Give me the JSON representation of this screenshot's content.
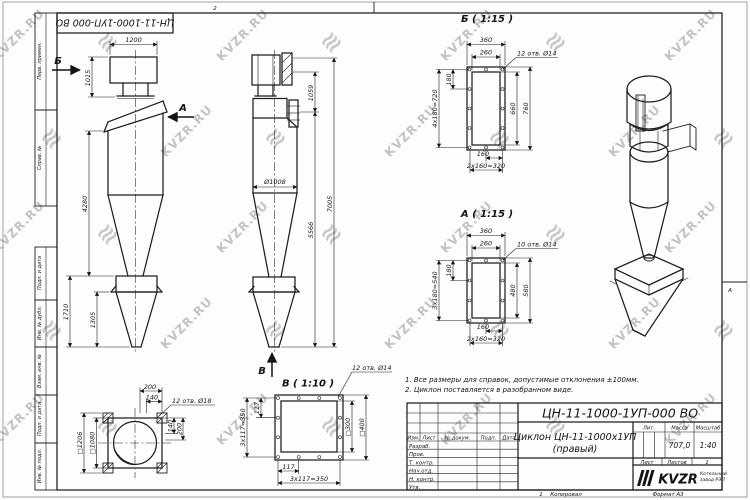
{
  "watermark": {
    "text": "KVZR.RU",
    "logo_glyph": "≋"
  },
  "frame": {
    "top_stamp": "ЦН-11-1000-1УП-000 ВО",
    "zone_top": "2",
    "zone_right": "А",
    "side_labels": [
      "Перв. примен.",
      "Справ. №",
      "Подп. и дата",
      "Инв. № дубл.",
      "Взам. инв. №",
      "Подп. и дата",
      "Инв. № подл."
    ],
    "footer": {
      "num": "1",
      "copy": "Копировал",
      "format": "Формат А3"
    }
  },
  "views": {
    "front": {
      "label_b": "Б",
      "label_a": "А",
      "dims": [
        "1200",
        "1015",
        "4280",
        "1710",
        "1305"
      ]
    },
    "side": {
      "label_v": "В",
      "dims": [
        "1059",
        "7005",
        "5566",
        "Ø1008"
      ]
    },
    "detail_b": {
      "title": "Б ( 1:15 )",
      "holes": "12 отв. Ø14",
      "dims": [
        "360",
        "260",
        "180",
        "4x180=720",
        "660",
        "760",
        "160",
        "2x160=320"
      ]
    },
    "detail_a": {
      "title": "А ( 1:15 )",
      "holes": "10 отв. Ø14",
      "dims": [
        "360",
        "260",
        "180",
        "3x180=540",
        "480",
        "580",
        "160",
        "2x160=320"
      ]
    },
    "detail_v": {
      "title": "В ( 1:10 )",
      "holes": "12 отв. Ø14",
      "dims": [
        "117",
        "3x117=350",
        "□300",
        "□400",
        "117",
        "3x117=350"
      ]
    },
    "top_view": {
      "holes": "12 отв. Ø18",
      "dims": [
        "200",
        "140",
        "□1206",
        "□1080",
        "140",
        "200"
      ]
    }
  },
  "notes": [
    "1. Все размеры для справок, допустимые отклонения ±100мм.",
    "2. Циклон поставляется в разобранном виде."
  ],
  "title_block": {
    "doc_no": "ЦН-11-1000-1УП-000 ВО",
    "name_line1": "Циклон ЦН-11-1000х1УП",
    "name_line2": "(правый)",
    "col_headers": [
      "Изм.",
      "Лист",
      "№ докум.",
      "Подп.",
      "Дата"
    ],
    "row_labels": [
      "Разраб.",
      "Пров.",
      "Т. контр.",
      "Нач.отд.",
      "Н. контр.",
      "Утв."
    ],
    "lit_label": "Лит.",
    "mass_label": "Масса",
    "scale_label": "Масштаб",
    "mass": "707,0",
    "scale": "1:40",
    "sheet_label": "Лист",
    "sheets_label": "Листов",
    "sheets_value": "1",
    "logo": "KVZR",
    "company_line1": "Котельный",
    "company_line2": "завод РЭП"
  }
}
